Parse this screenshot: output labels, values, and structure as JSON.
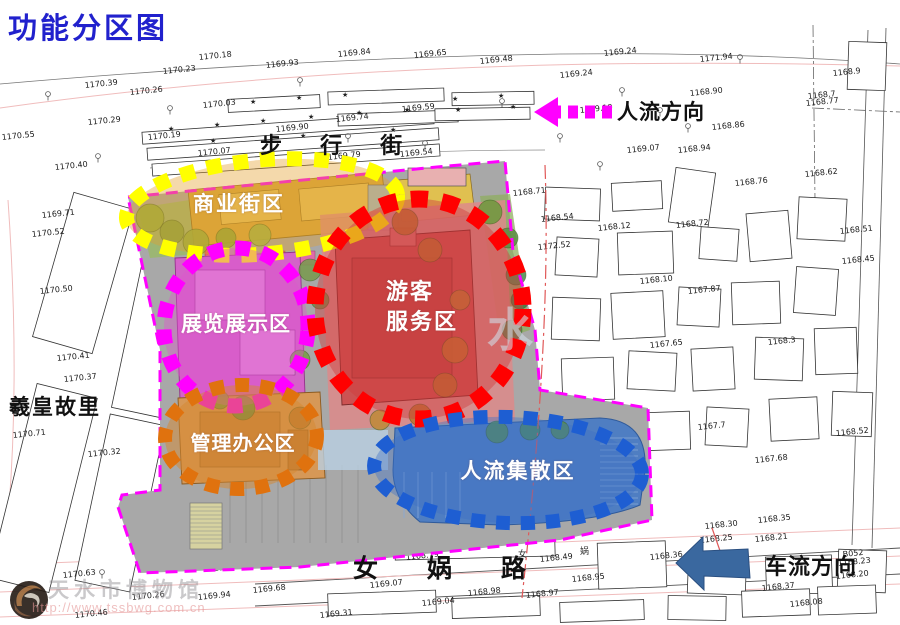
{
  "title": "功能分区图",
  "title_color": "#2121cd",
  "zones": [
    {
      "name": "commercial-street-zone",
      "label": "商业街区",
      "dot_color": "#ffff00",
      "tint": "rgba(228,160,45,0.40)",
      "label_color": "#ffffff"
    },
    {
      "name": "exhibition-zone",
      "label": "展览展示区",
      "dot_color": "#ff00ff",
      "tint": "rgba(222,85,205,0.40)",
      "label_color": "#ffffff"
    },
    {
      "name": "visitor-service-zone",
      "label": "游客\n服务区",
      "dot_color": "#ff0000",
      "tint": "rgba(208,60,60,0.45)",
      "label_color": "#ffffff"
    },
    {
      "name": "admin-office-zone",
      "label": "管理办公区",
      "dot_color": "#e0720e",
      "tint": "rgba(214,136,48,0.50)",
      "label_color": "#ffffff"
    },
    {
      "name": "circulation-zone",
      "label": "人流集散区",
      "dot_color": "#1e5ed2",
      "tint": "rgba(62,112,198,0.40)",
      "label_color": "#ffffff"
    }
  ],
  "arrows": {
    "flow": {
      "label": "人流方向",
      "color": "#ff00ff"
    },
    "vehicle": {
      "label": "车流方向",
      "color": "#3a689f"
    }
  },
  "streets": {
    "pedestrian": "步 行 街",
    "nvwa": "女 娲 路",
    "xihuang": "羲皇故里"
  },
  "watermark": {
    "name": "天水市博物馆",
    "url": "http://www.tssbwg.com.cn",
    "faint_center": "水"
  },
  "site": {
    "boundary_color": "#ff00ff",
    "trees": [
      [
        150,
        218,
        14,
        "#8faf3f"
      ],
      [
        172,
        232,
        12,
        "#7da23f"
      ],
      [
        196,
        242,
        13,
        "#8faf3f"
      ],
      [
        226,
        238,
        10,
        "#87a83a"
      ],
      [
        260,
        235,
        11,
        "#9ab84a"
      ],
      [
        490,
        212,
        12,
        "#6f9a3f"
      ],
      [
        508,
        238,
        10,
        "#5d8f46"
      ],
      [
        310,
        270,
        11,
        "#7a9a50"
      ],
      [
        320,
        300,
        9,
        "#6d8f4a"
      ],
      [
        300,
        360,
        10,
        "#78a047"
      ],
      [
        405,
        222,
        13,
        "#b9762f"
      ],
      [
        430,
        250,
        12,
        "#b9762f"
      ],
      [
        460,
        300,
        10,
        "#bd8035"
      ],
      [
        455,
        350,
        13,
        "#c07a30"
      ],
      [
        445,
        385,
        12,
        "#b9762f"
      ],
      [
        243,
        408,
        12,
        "#5d8f46"
      ],
      [
        220,
        400,
        9,
        "#6d9a40"
      ],
      [
        300,
        418,
        11,
        "#b9762f"
      ],
      [
        380,
        420,
        10,
        "#c08a3a"
      ],
      [
        420,
        415,
        11,
        "#b9762f"
      ],
      [
        516,
        275,
        10,
        "#4e8d52"
      ],
      [
        520,
        300,
        9,
        "#3f7f46"
      ],
      [
        512,
        330,
        10,
        "#4e8d52"
      ],
      [
        497,
        432,
        11,
        "#58904a"
      ],
      [
        530,
        430,
        10,
        "#4e8d52"
      ],
      [
        560,
        430,
        9,
        "#58904a"
      ]
    ]
  },
  "survey": {
    "elevations": [
      [
        "1170.55",
        2,
        140
      ],
      [
        "1170.29",
        88,
        125
      ],
      [
        "1170.19",
        148,
        140
      ],
      [
        "1170.40",
        55,
        170
      ],
      [
        "1170.23",
        163,
        74
      ],
      [
        "1170.39",
        85,
        88
      ],
      [
        "1170.26",
        130,
        95
      ],
      [
        "1170.18",
        199,
        60
      ],
      [
        "1169.93",
        266,
        68
      ],
      [
        "1170.03",
        203,
        108
      ],
      [
        "1169.84",
        338,
        57
      ],
      [
        "1169.65",
        414,
        58
      ],
      [
        "1169.48",
        480,
        64
      ],
      [
        "1169.24",
        604,
        56
      ],
      [
        "1169.24",
        560,
        78
      ],
      [
        "1169.59",
        402,
        112
      ],
      [
        "1169.90",
        276,
        132
      ],
      [
        "1169.74",
        336,
        122
      ],
      [
        "1169.79",
        328,
        160
      ],
      [
        "1169.54",
        400,
        157
      ],
      [
        "1169.19",
        580,
        113
      ],
      [
        "1169.07",
        627,
        153
      ],
      [
        "1168.94",
        678,
        153
      ],
      [
        "1168.90",
        690,
        96
      ],
      [
        "1171.94",
        700,
        62
      ],
      [
        "1168.86",
        712,
        130
      ],
      [
        "1168.76",
        735,
        186
      ],
      [
        "1168.77",
        806,
        106
      ],
      [
        "1168.62",
        805,
        177
      ],
      [
        "1170.07",
        198,
        156
      ],
      [
        "1168.71",
        513,
        196
      ],
      [
        "1168.54",
        541,
        222
      ],
      [
        "1172.52",
        538,
        250
      ],
      [
        "1168.12",
        598,
        231
      ],
      [
        "1168.10",
        640,
        284
      ],
      [
        "1167.87",
        688,
        294
      ],
      [
        "1167.65",
        650,
        348
      ],
      [
        "1168.72",
        676,
        228
      ],
      [
        "1168.51",
        840,
        234
      ],
      [
        "1168.45",
        842,
        264
      ],
      [
        "1168.3",
        768,
        345
      ],
      [
        "1168.52",
        836,
        436
      ],
      [
        "1167.68",
        755,
        463
      ],
      [
        "1167.7",
        698,
        430
      ],
      [
        "1168.17",
        618,
        514
      ],
      [
        "1168.35",
        758,
        523
      ],
      [
        "1168.30",
        705,
        529
      ],
      [
        "1168.21",
        755,
        542
      ],
      [
        "1168.36",
        650,
        560
      ],
      [
        "1168.23",
        838,
        566
      ],
      [
        "1168.20",
        836,
        579
      ],
      [
        "1168.37",
        762,
        591
      ],
      [
        "1168.08",
        790,
        607
      ],
      [
        "1168.25",
        700,
        543
      ],
      [
        "1169.71",
        42,
        218
      ],
      [
        "1170.52",
        32,
        237
      ],
      [
        "1170.50",
        40,
        294
      ],
      [
        "1170.41",
        57,
        361
      ],
      [
        "1170.37",
        64,
        382
      ],
      [
        "1170.71",
        13,
        438
      ],
      [
        "1170.32",
        88,
        457
      ],
      [
        "1170.63",
        63,
        578
      ],
      [
        "1170.26",
        132,
        600
      ],
      [
        "1170.46",
        75,
        618
      ],
      [
        "1170.16",
        214,
        571
      ],
      [
        "1169.94",
        198,
        600
      ],
      [
        "1169.68",
        253,
        593
      ],
      [
        "1169.07",
        370,
        588
      ],
      [
        "1168.79",
        406,
        560
      ],
      [
        "1168.49",
        540,
        562
      ],
      [
        "1168.95",
        572,
        582
      ],
      [
        "1168.98",
        468,
        596
      ],
      [
        "1168.97",
        526,
        598
      ],
      [
        "1169.04",
        422,
        606
      ],
      [
        "1169.31",
        320,
        618
      ],
      [
        "1168.9",
        833,
        76
      ],
      [
        "1168.7",
        808,
        99
      ],
      [
        "B052",
        843,
        557
      ]
    ],
    "stars": [
      [
        168,
        131
      ],
      [
        214,
        127
      ],
      [
        260,
        123
      ],
      [
        308,
        119
      ],
      [
        356,
        115
      ],
      [
        404,
        112
      ],
      [
        250,
        104
      ],
      [
        296,
        100
      ],
      [
        342,
        97
      ],
      [
        452,
        101
      ],
      [
        498,
        98
      ],
      [
        210,
        143
      ],
      [
        300,
        138
      ],
      [
        390,
        132
      ],
      [
        455,
        112
      ],
      [
        510,
        109
      ]
    ],
    "tree_markers": [
      [
        48,
        94
      ],
      [
        98,
        156
      ],
      [
        142,
        212
      ],
      [
        348,
        136
      ],
      [
        425,
        143
      ],
      [
        502,
        101
      ],
      [
        560,
        136
      ],
      [
        622,
        90
      ],
      [
        688,
        126
      ],
      [
        740,
        57
      ],
      [
        102,
        572
      ],
      [
        170,
        108
      ],
      [
        300,
        80
      ],
      [
        600,
        164
      ],
      [
        660,
        110
      ]
    ],
    "road_names": [
      [
        "女",
        518,
        557
      ],
      [
        "娲",
        580,
        554
      ]
    ]
  }
}
